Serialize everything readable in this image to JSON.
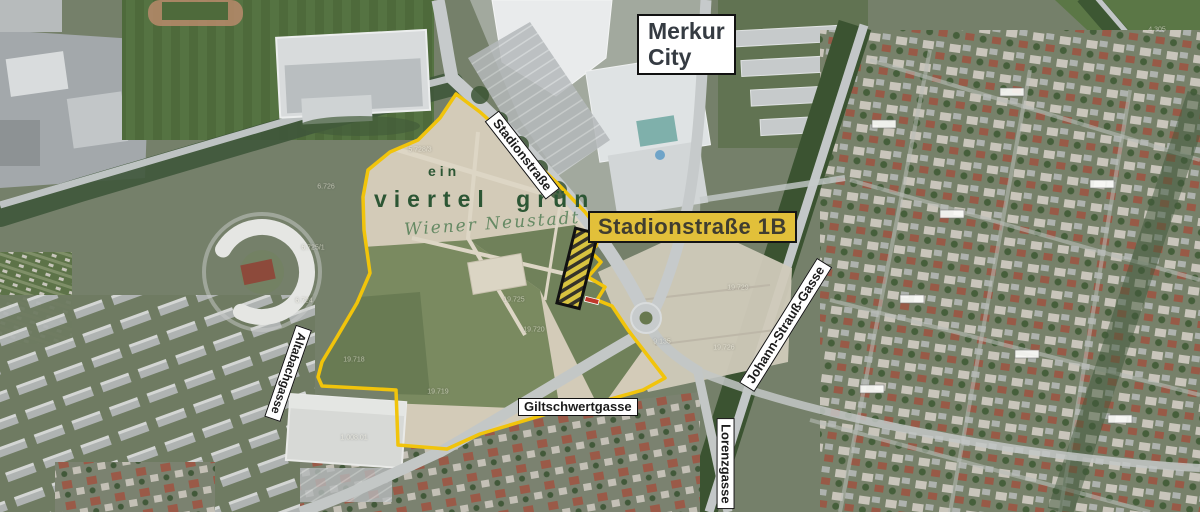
{
  "map": {
    "poi": {
      "merkur_line1": "Merkur",
      "merkur_line2": "City"
    },
    "highlight": {
      "label": "Stadionstraße 1B"
    },
    "project": {
      "line1": "ein",
      "line2": "viertel grün",
      "tagline": "Wiener Neustadt"
    },
    "streets": [
      {
        "id": "stadionstrasse",
        "label": "Stadionstraße"
      },
      {
        "id": "giltschwertgasse",
        "label": "Giltschwertgasse"
      },
      {
        "id": "johann-strauss-gasse",
        "label": "Johann-Strauß-Gasse"
      },
      {
        "id": "lorenzgasse",
        "label": "Lorenzgasse"
      },
      {
        "id": "altabachgasse",
        "label": "Altabachgasse"
      }
    ],
    "colors": {
      "boundary_yellow": "#f1c40b",
      "highlight_bg": "#e2c03a",
      "highlight_text": "#403d30",
      "project_green": "#2c5634",
      "label_bg": "#ffffff",
      "label_border": "#111111"
    },
    "parcel_labels": [
      {
        "text": "5.728/3",
        "x": 420,
        "y": 150
      },
      {
        "text": "6.726",
        "x": 326,
        "y": 187
      },
      {
        "text": "6.725/1",
        "x": 313,
        "y": 248
      },
      {
        "text": "6.724",
        "x": 304,
        "y": 301
      },
      {
        "text": "19.718",
        "x": 354,
        "y": 360
      },
      {
        "text": "19.725",
        "x": 514,
        "y": 300
      },
      {
        "text": "19.720",
        "x": 534,
        "y": 330
      },
      {
        "text": "19.719",
        "x": 438,
        "y": 392
      },
      {
        "text": "1.008.01",
        "x": 354,
        "y": 438
      },
      {
        "text": "9.135",
        "x": 662,
        "y": 342
      },
      {
        "text": "19.726",
        "x": 724,
        "y": 348
      },
      {
        "text": "19.729",
        "x": 738,
        "y": 288
      },
      {
        "text": "4.305",
        "x": 1157,
        "y": 30
      }
    ]
  }
}
